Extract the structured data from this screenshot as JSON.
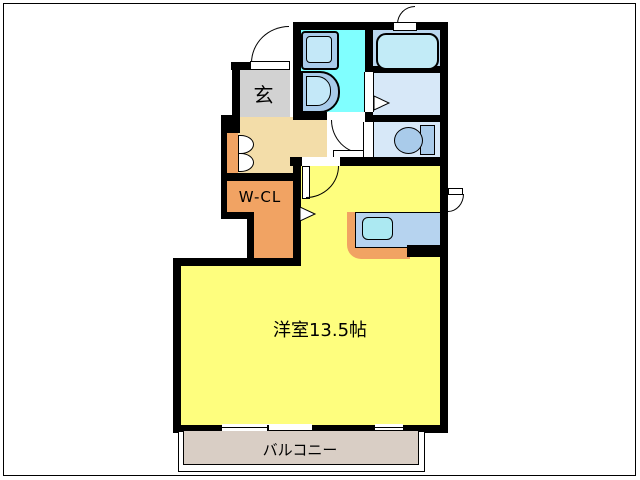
{
  "plan_title": "apartment-floor-plan",
  "rooms": {
    "genkan": {
      "label": "玄"
    },
    "wcl": {
      "label": "W-CL"
    },
    "main": {
      "label": "洋室13.5帖"
    },
    "balcony": {
      "label": "バルコニー"
    }
  },
  "fixtures": [
    "entry-door",
    "washing-machine-pan",
    "vanity-sink",
    "bathtub",
    "toilet",
    "kitchen-counter",
    "kitchen-sink",
    "closet-double-doors",
    "sliding-window",
    "small-window",
    "vent-door",
    "service-door"
  ],
  "colors": {
    "wall": "#000000",
    "main_room": "#FEFE7E",
    "hallway": "#F3DDA9",
    "orange_closet": "#F1A363",
    "genkan_gray": "#D2D2D2",
    "washroom_cyan": "#80FFFF",
    "bath_blue": "#BAD7EF",
    "water_room_blue": "#D7E8F8",
    "fixture_blue": "#A9CBEA",
    "fixture_inner": "#C4E8F8",
    "bathtub_fill": "#C2EBF7",
    "counter_top": "#B6D3EF",
    "sink_cyan": "#ACE9F2",
    "balcony_beige": "#D9CEC5",
    "background": "#FFFFFF"
  }
}
